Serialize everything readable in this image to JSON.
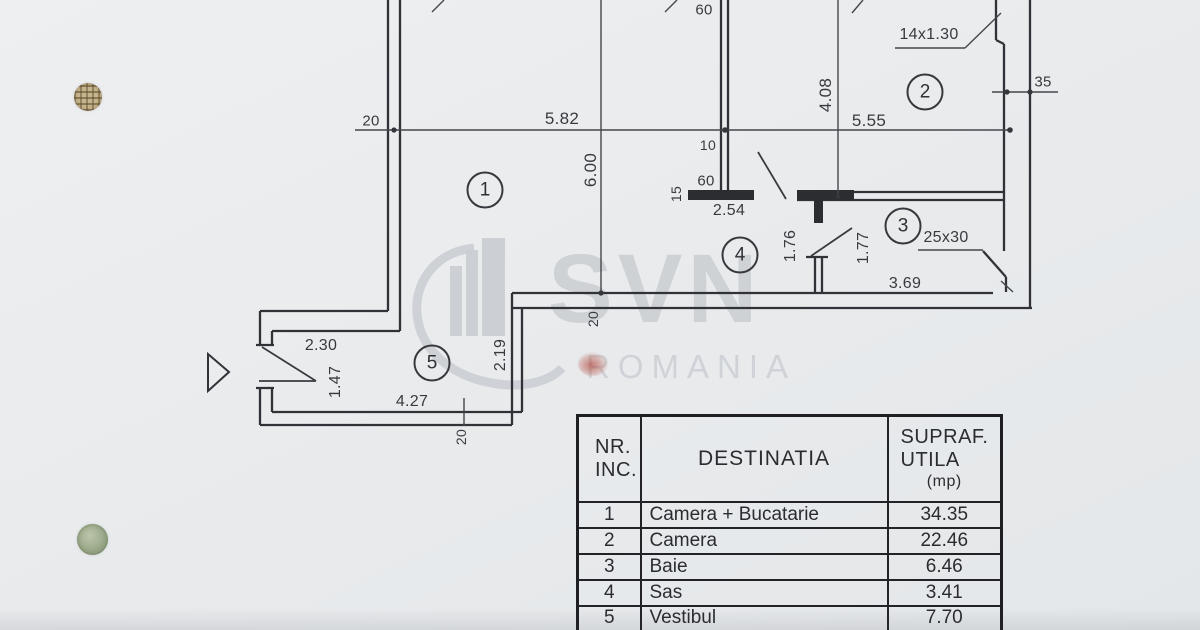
{
  "watermark": {
    "brand": "SVN",
    "country": "ROMANIA"
  },
  "plan": {
    "dimension_labels": [
      {
        "text": "20",
        "x": 371,
        "y": 121,
        "rot": false,
        "size": 15
      },
      {
        "text": "5.82",
        "x": 562,
        "y": 119,
        "rot": false,
        "size": 17
      },
      {
        "text": "5.55",
        "x": 869,
        "y": 121,
        "rot": false,
        "size": 17
      },
      {
        "text": "6.00",
        "x": 591,
        "y": 170,
        "rot": true,
        "size": 17
      },
      {
        "text": "4.08",
        "x": 826,
        "y": 95,
        "rot": true,
        "size": 17
      },
      {
        "text": "14x1.30",
        "x": 929,
        "y": 35,
        "rot": false,
        "size": 16
      },
      {
        "text": "35",
        "x": 1043,
        "y": 82,
        "rot": false,
        "size": 15
      },
      {
        "text": "60",
        "x": 704,
        "y": 10,
        "rot": false,
        "size": 15
      },
      {
        "text": "10",
        "x": 708,
        "y": 145,
        "rot": false,
        "size": 14
      },
      {
        "text": "60",
        "x": 706,
        "y": 181,
        "rot": false,
        "size": 15
      },
      {
        "text": "15",
        "x": 676,
        "y": 194,
        "rot": true,
        "size": 14
      },
      {
        "text": "2.54",
        "x": 729,
        "y": 211,
        "rot": false,
        "size": 16
      },
      {
        "text": "1.76",
        "x": 791,
        "y": 246,
        "rot": true,
        "size": 16
      },
      {
        "text": "1.77",
        "x": 864,
        "y": 248,
        "rot": true,
        "size": 16
      },
      {
        "text": "25x30",
        "x": 946,
        "y": 238,
        "rot": false,
        "size": 16
      },
      {
        "text": "3.69",
        "x": 905,
        "y": 284,
        "rot": false,
        "size": 16
      },
      {
        "text": "2.30",
        "x": 321,
        "y": 346,
        "rot": false,
        "size": 16
      },
      {
        "text": "1.47",
        "x": 336,
        "y": 382,
        "rot": true,
        "size": 16
      },
      {
        "text": "4.27",
        "x": 412,
        "y": 402,
        "rot": false,
        "size": 16
      },
      {
        "text": "2.19",
        "x": 501,
        "y": 355,
        "rot": true,
        "size": 16
      },
      {
        "text": "20",
        "x": 593,
        "y": 319,
        "rot": true,
        "size": 14
      },
      {
        "text": "20",
        "x": 461,
        "y": 437,
        "rot": true,
        "size": 14
      }
    ],
    "room_markers": [
      {
        "num": "1",
        "x": 485,
        "y": 190
      },
      {
        "num": "2",
        "x": 925,
        "y": 92
      },
      {
        "num": "3",
        "x": 903,
        "y": 226
      },
      {
        "num": "4",
        "x": 740,
        "y": 255
      },
      {
        "num": "5",
        "x": 432,
        "y": 363
      }
    ]
  },
  "table": {
    "col1_header_lines": [
      "NR.",
      "INC."
    ],
    "col2_header": "DESTINATIA",
    "col3_header_lines": [
      "SUPRAF.",
      "UTILA",
      "(mp)"
    ],
    "rows": [
      {
        "nr": "1",
        "destinatia": "Camera + Bucatarie",
        "suprafata": "34.35"
      },
      {
        "nr": "2",
        "destinatia": "Camera",
        "suprafata": "22.46"
      },
      {
        "nr": "3",
        "destinatia": "Baie",
        "suprafata": "6.46"
      },
      {
        "nr": "4",
        "destinatia": "Sas",
        "suprafata": "3.41"
      },
      {
        "nr": "5",
        "destinatia": "Vestibul",
        "suprafata": "7.70"
      }
    ]
  }
}
